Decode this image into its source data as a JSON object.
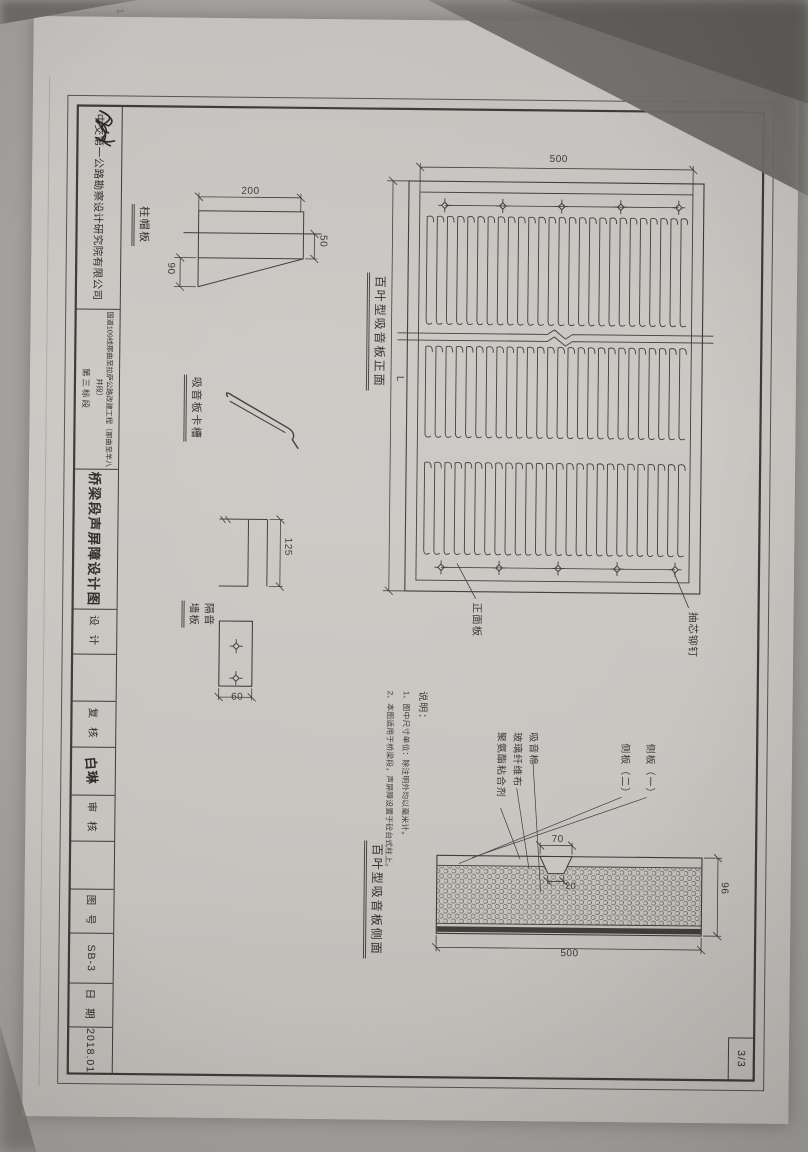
{
  "page": {
    "page_number": "3/3",
    "corner_mark": "1"
  },
  "title_block": {
    "company": "中交第一公路勘察设计研究院有限公司",
    "project_line1": "国道109线那曲至拉萨公路改建工程（那曲至羊八井段）",
    "project_line2": "第三标段",
    "drawing_title": "桥梁段声屏障设计图",
    "design_label": "设 计",
    "check_label": "复 核",
    "checker_name": "白琳",
    "review_label": "审 核",
    "drawing_no_label": "图 号",
    "drawing_no": "SB-3",
    "date_label": "日 期",
    "date": "2018.01"
  },
  "front_view": {
    "title": "百叶型吸音板正面",
    "dim_height": "500",
    "dim_length": "L",
    "label_front_panel": "正面板",
    "label_rivet": "抽芯铆钉"
  },
  "details": {
    "cap_plate": {
      "title": "柱帽板",
      "dim_200": "200",
      "dim_50": "50",
      "dim_90": "90"
    },
    "clip": {
      "title": "吸音板卡槽"
    },
    "channel": {
      "dim_125": "125"
    },
    "wall_panel": {
      "title_line1": "隔音",
      "title_line2": "墙板",
      "dim_60": "60"
    }
  },
  "side_view": {
    "title": "百叶型吸音板侧面",
    "dim_70": "70",
    "dim_20": "20",
    "dim_96": "96",
    "dim_500": "500",
    "layer_labels": [
      "吸音棉",
      "玻璃纤维布",
      "聚氨酯粘合剂"
    ],
    "plate_labels": [
      "侧板（一）",
      "侧板（二）"
    ]
  },
  "notes": {
    "heading": "说明：",
    "items": [
      "1、图中尺寸单位：除注明外均以毫米计。",
      "2、本图适用于桥梁段，声屏障设置于砼台式柱上。"
    ]
  }
}
